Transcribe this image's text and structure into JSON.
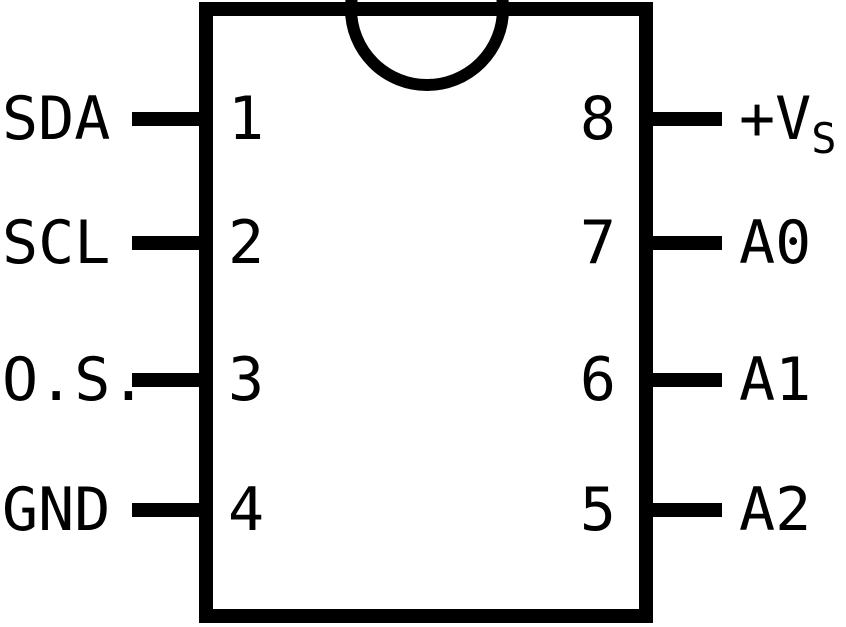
{
  "diagram": {
    "type": "ic-pinout",
    "package": "8-pin dual-in-line, top view",
    "colors": {
      "line": "#000000",
      "background": "#ffffff"
    },
    "pins": {
      "left": [
        {
          "number": "1",
          "label": "SDA"
        },
        {
          "number": "2",
          "label": "SCL"
        },
        {
          "number": "3",
          "label": "O.S."
        },
        {
          "number": "4",
          "label": "GND"
        }
      ],
      "right": [
        {
          "number": "8",
          "label": "+V",
          "label_sub": "S"
        },
        {
          "number": "7",
          "label": "A0",
          "label_sub": ""
        },
        {
          "number": "6",
          "label": "A1",
          "label_sub": ""
        },
        {
          "number": "5",
          "label": "A2",
          "label_sub": ""
        }
      ]
    }
  }
}
